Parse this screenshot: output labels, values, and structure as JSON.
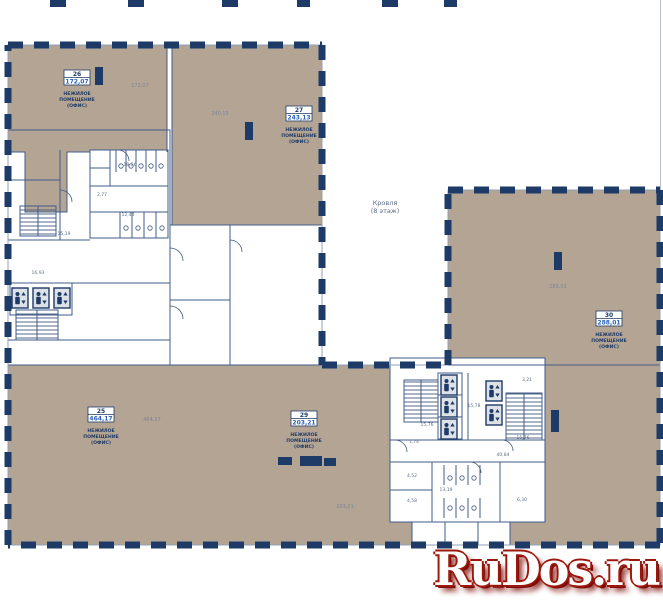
{
  "watermark": "RuDos.ru",
  "caption": {
    "line1": "НЕЖИЛОЕ",
    "line2": "ПОМЕЩЕНИЕ",
    "line3": "(ОФИС)"
  },
  "center_note": {
    "line1": "Кровля",
    "line2": "(8 этаж)"
  },
  "offices": {
    "o26": {
      "num": "26",
      "area": "172,07"
    },
    "o27": {
      "num": "27",
      "area": "243,13"
    },
    "o30": {
      "num": "30",
      "area": "288,01"
    },
    "o25": {
      "num": "25",
      "area": "464,17"
    },
    "o29": {
      "num": "29",
      "area": "203,21"
    }
  },
  "floating_areas": {
    "a26": "172,07",
    "a27": "240,15",
    "a30": "288,01",
    "a25": "464,17",
    "a29": "203,21"
  },
  "small_rooms": {
    "wc_top": "18,56",
    "wc_small": "2,77",
    "wc_bottom": "12,44",
    "corridor_left": "16,93",
    "stair_left": "15,19",
    "stair_bl_left": "15,76",
    "lobby": "15,78",
    "stair_bl_right": "15,76",
    "corridor_right": "40,84",
    "wc_br": "13,19",
    "room_452": "4,52",
    "room_458": "4,58",
    "room_630": "6,30",
    "room_321": "3,21",
    "room_174": "1,74"
  },
  "colors": {
    "wall": "#1e3a66",
    "room_fill": "#b4a494",
    "area_blue": "#2a62b8",
    "watermark_red": "#9c170c"
  }
}
